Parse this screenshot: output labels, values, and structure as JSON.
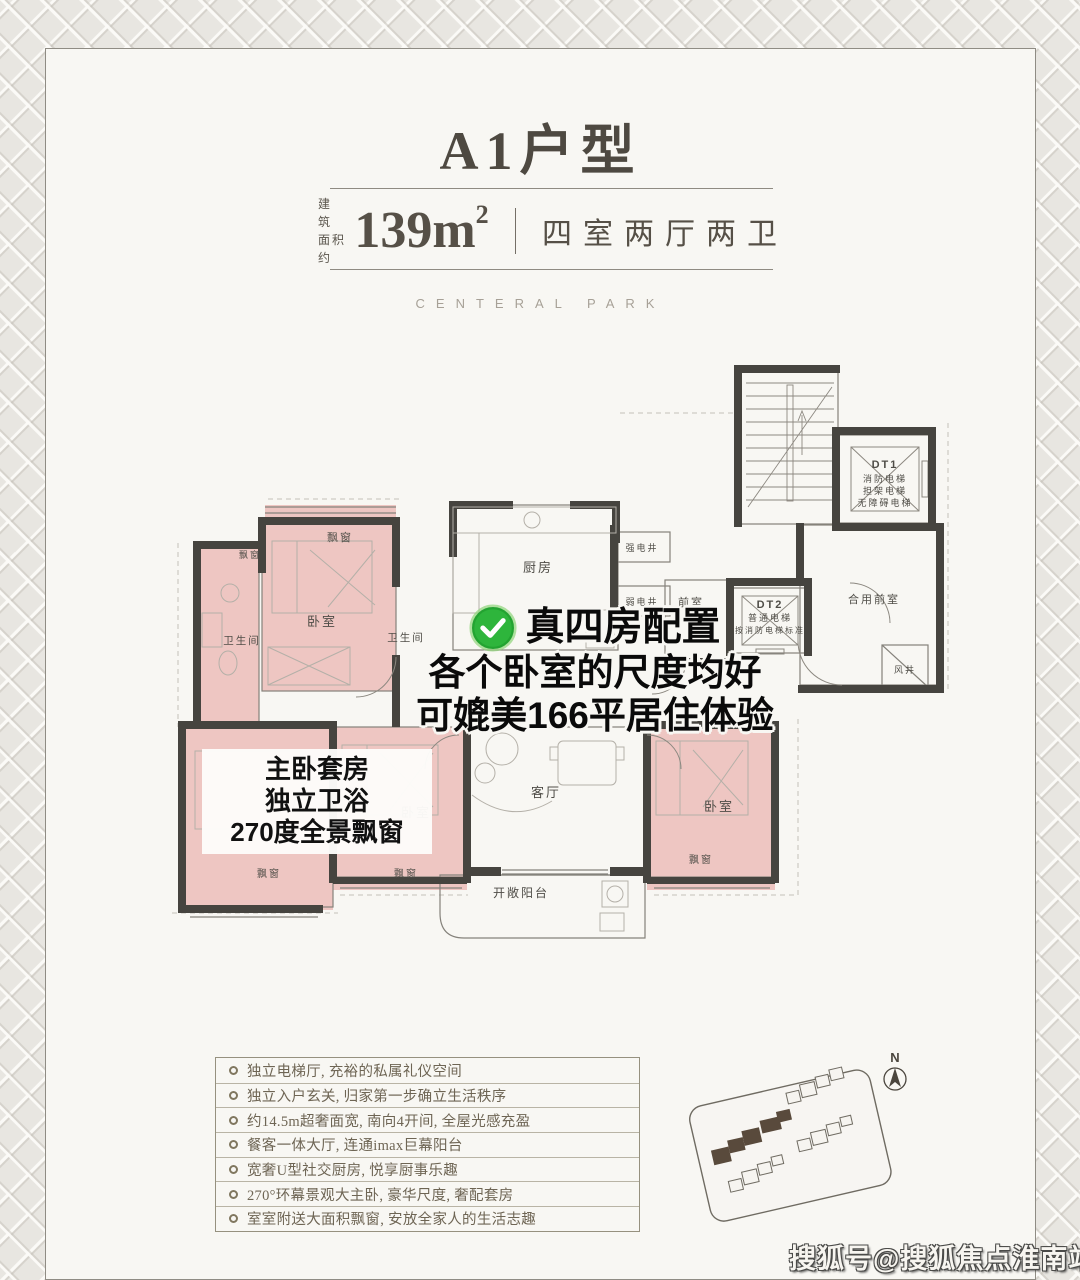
{
  "header": {
    "title": "A1户型",
    "area_prefix_line1": "建　筑",
    "area_prefix_line2": "面积约",
    "area_value": "139m",
    "area_sup": "2",
    "rooms_spec": "四室两厅两卫",
    "brand": "CENTERAL PARK"
  },
  "plan": {
    "labels": {
      "bay_window": "飘窗",
      "bedroom": "卧室",
      "bathroom": "卫生间",
      "kitchen": "厨房",
      "strong_shaft": "强电井",
      "weak_shaft": "弱电井",
      "front_room": "前室",
      "shared_front_room": "合用前室",
      "wind_shaft": "风井",
      "living_room": "客厅",
      "balcony": "开敞阳台"
    },
    "dt1": {
      "name": "DT1",
      "lines": [
        "消防电梯",
        "担架电梯",
        "无障碍电梯"
      ]
    },
    "dt2": {
      "name": "DT2",
      "lines": [
        "普通电梯",
        "按消防电梯标准"
      ]
    }
  },
  "callouts": {
    "check": {
      "line1": "真四房配置",
      "line2": "各个卧室的尺度均好",
      "line3": "可媲美166平居住体验"
    },
    "master": {
      "line1": "主卧套房",
      "line2": "独立卫浴",
      "line3": "270度全景飘窗"
    }
  },
  "features": {
    "items": [
      "独立电梯厅, 充裕的私属礼仪空间",
      "独立入户玄关, 归家第一步确立生活秩序",
      "约14.5m超奢面宽, 南向4开间, 全屋光感充盈",
      "餐客一体大厅, 连通imax巨幕阳台",
      "宽奢U型社交厨房, 悦享厨事乐趣",
      "270°环幕景观大主卧, 豪华尺度, 奢配套房",
      "室室附送大面积飘窗, 安放全家人的生活志趣"
    ]
  },
  "siteplan": {
    "compass": "N"
  },
  "watermark": {
    "text": "搜狐号@搜狐焦点淮南站"
  },
  "colors": {
    "accent_green": "#2eb53c",
    "highlight_pink": "#e9a8a3",
    "wall_dark": "#46443f",
    "title_text": "#4e4941",
    "card_bg": "#f8f7f3"
  }
}
